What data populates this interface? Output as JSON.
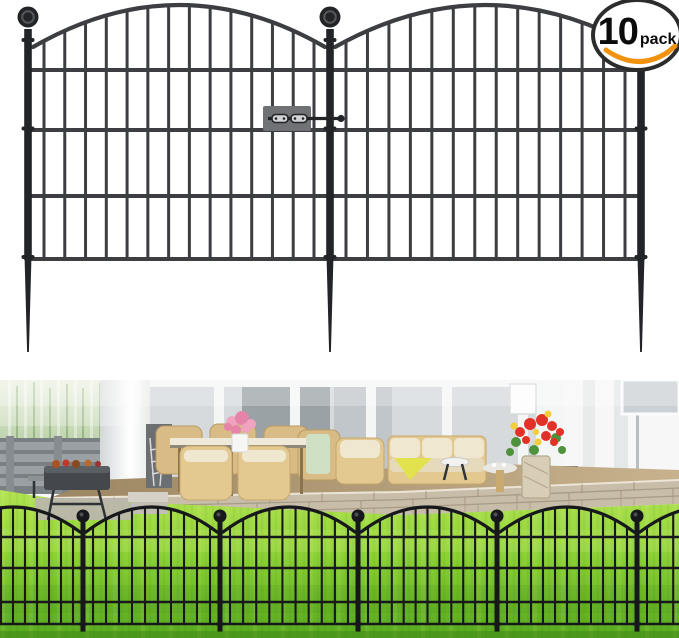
{
  "badge": {
    "count": "10",
    "unit": "pack"
  },
  "colors": {
    "fence_metal": "#3c3e41",
    "fence_metal_dark": "#232427",
    "connector_plate": "#707275",
    "fence_black": "#17181b",
    "badge_border": "#2c2c2c",
    "badge_text": "#0b0b0b",
    "swoosh_orange": "#f0920e",
    "wall_white": "#f6f7f6",
    "glass_gray": "#d6dadc",
    "lawn_light": "#b3e352",
    "lawn_mid": "#8bd135",
    "lawn_dark": "#57a81f",
    "patio_tan": "#c7b28d",
    "patio_dark": "#9d8662",
    "brick_light": "#c8bda9",
    "brick_joint": "#a3977f",
    "wicker_tan": "#d9bc85",
    "cushion_cream": "#f0e7d1",
    "throw_yellow": "#e2e24f",
    "flower_red": "#e23227",
    "flower_pink": "#f0a3bf",
    "grass_green": "#9cbd85",
    "wood_fence_gray": "#9aa0a3"
  },
  "render_config": {
    "illustration": {
      "posts_x": [
        28,
        330,
        641
      ],
      "post_top_y": 29,
      "rail_ys": [
        70,
        130,
        196,
        259
      ],
      "arch_spring_y": 47,
      "arch_ctrl_y": -37,
      "ball_cy": 17,
      "ball_r": 10.5,
      "collar_ys": [
        40,
        128.5,
        257
      ],
      "spike_tip_y": 352,
      "bars_per_panel": 14,
      "bar_margin": 16,
      "plate": {
        "x": 263,
        "y": 106,
        "w": 48,
        "h": 25,
        "bolt_y": 118.5,
        "bolt_x1": 268,
        "bolt_x2": 341
      }
    },
    "photo_fence": {
      "posts_x": [
        -57,
        83,
        220,
        358,
        497,
        637
      ],
      "virtual_right": 775,
      "rail_ys": [
        157,
        188,
        222,
        244
      ],
      "arch_spring_y": 152,
      "arch_ctrl_y": 102,
      "ball_cy": 136,
      "ball_r": 6.5,
      "post_top_y": 142,
      "post_bottom_y": 252,
      "bar_pitch": 12.5,
      "bar_margin": 10
    }
  }
}
